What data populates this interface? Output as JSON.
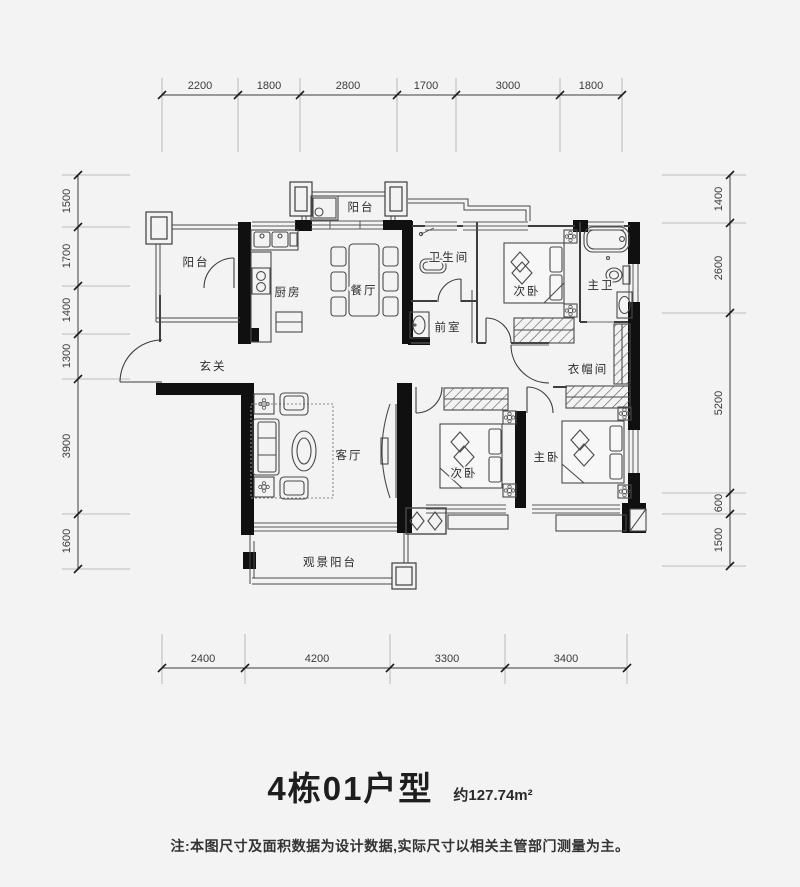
{
  "dimensions": {
    "top": [
      "2200",
      "1800",
      "2800",
      "1700",
      "3000",
      "1800"
    ],
    "left": [
      "1500",
      "1700",
      "1400",
      "1300",
      "3900",
      "1600"
    ],
    "right": [
      "1400",
      "2600",
      "5200",
      "600",
      "1500"
    ],
    "bottom": [
      "2400",
      "4200",
      "3300",
      "3400"
    ]
  },
  "rooms": {
    "balcony_top": "阳台",
    "balcony_left": "阳台",
    "kitchen": "厨房",
    "dining": "餐厅",
    "bathroom": "卫生间",
    "vestibule": "前室",
    "bedroom2_top": "次卧",
    "master_bath": "主卫",
    "entry": "玄关",
    "cloakroom": "衣帽间",
    "living": "客厅",
    "bedroom2_bottom": "次卧",
    "master_bedroom": "主卧",
    "view_balcony": "观景阳台"
  },
  "title": {
    "unit": "4栋01户型",
    "area": "约127.74m²"
  },
  "note": "注:本图尺寸及面积数据为设计数据,实际尺寸以相关主管部门测量为主。",
  "colors": {
    "background": "#f3f3f4",
    "line": "#3d3d3d",
    "wall": "#101010",
    "text": "#2c2c2c"
  }
}
